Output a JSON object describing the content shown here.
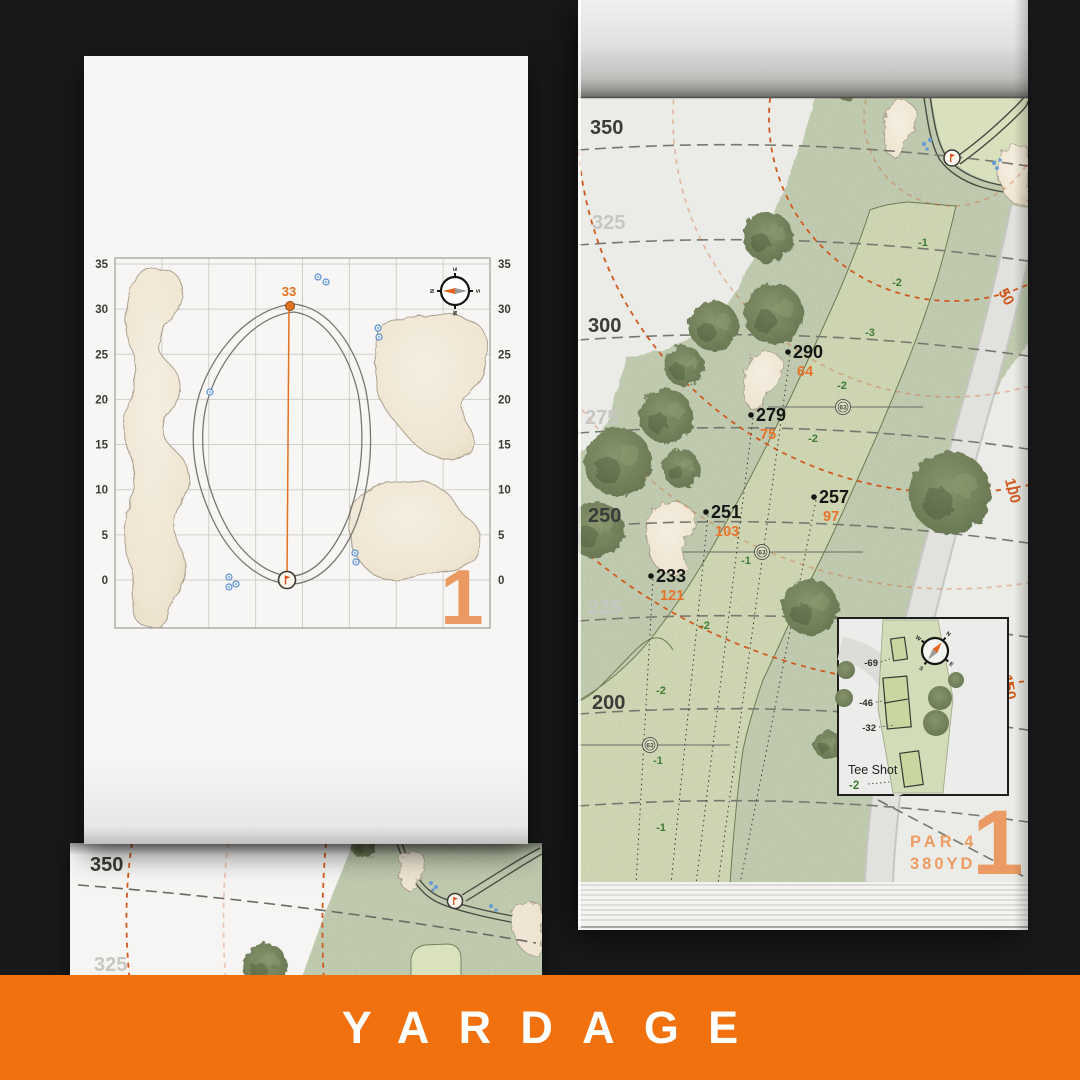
{
  "banner": {
    "title": "YARDAGE"
  },
  "left_page": {
    "hole_number": "1",
    "pin_distance": "33",
    "axis_ticks": [
      "35",
      "30",
      "25",
      "20",
      "15",
      "10",
      "5",
      "0"
    ],
    "compass_letters": {
      "n": "N",
      "e": "E",
      "s": "S",
      "w": "W"
    }
  },
  "right_page": {
    "hole_number": "1",
    "par_label": "PAR 4",
    "yardage_label": "380YD",
    "yardlines": [
      {
        "label": "350",
        "faded": false
      },
      {
        "label": "325",
        "faded": true
      },
      {
        "label": "300",
        "faded": false
      },
      {
        "label": "275",
        "faded": true
      },
      {
        "label": "250",
        "faded": false
      },
      {
        "label": "225",
        "faded": true
      },
      {
        "label": "200",
        "faded": false
      }
    ],
    "distance_arcs": [
      "50",
      "100",
      "150"
    ],
    "shot_markers": [
      {
        "carry": "290",
        "to_green": "64"
      },
      {
        "carry": "279",
        "to_green": "75"
      },
      {
        "carry": "257",
        "to_green": "97"
      },
      {
        "carry": "251",
        "to_green": "103"
      },
      {
        "carry": "233",
        "to_green": "121"
      }
    ],
    "fairway_deltas": [
      "-1",
      "-2",
      "-3",
      "-2",
      "-2",
      "-1",
      "-2",
      "-2",
      "-1",
      "-1"
    ],
    "sprinkler_yardage": "63",
    "tee_inset": {
      "title": "Tee Shot",
      "delta": "-2",
      "offsets": [
        "-69",
        "-46",
        "-32"
      ]
    },
    "compass_letters": {
      "n": "N",
      "e": "E",
      "s": "S",
      "w": "W"
    }
  },
  "under_page": {
    "yardlines": [
      {
        "label": "350",
        "faded": false
      },
      {
        "label": "325",
        "faded": true
      }
    ]
  },
  "palette": {
    "banner_orange": "#F1710E",
    "accent_orange": "#E2721F",
    "numeral_orange": "#EA9A62",
    "remain_orange": "#E8732A",
    "arc_orange": "#D05A1E",
    "delta_green": "#3F7A33",
    "fairway_green": "#CBD5BA",
    "bunker_sand": "#F0E7D6"
  }
}
